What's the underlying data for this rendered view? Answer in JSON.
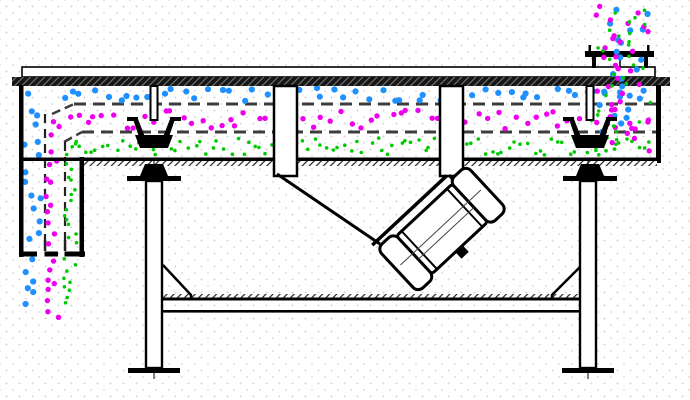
{
  "diagram": {
    "background": "#ffffff",
    "line_color": "#000000",
    "mesh_dash_color": "#3c3c3c"
  },
  "particle_colors": {
    "coarse": "#1E90FF",
    "medium": "#EE00EE",
    "fine": "#00CB00"
  },
  "particle_regions": [
    {
      "id": "coarse-top-deck-band",
      "layer": "mid",
      "color": "coarse",
      "r": 3.1,
      "axis": "x",
      "x": [
        55,
        650
      ],
      "y": [
        88,
        101
      ],
      "count": 52,
      "seed": 11
    },
    {
      "id": "medium-mid-deck-band",
      "layer": "mid",
      "color": "medium",
      "r": 2.7,
      "axis": "x",
      "x": [
        62,
        652
      ],
      "y": [
        110,
        129
      ],
      "count": 62,
      "seed": 22
    },
    {
      "id": "fine-bottom-pan-band",
      "layer": "mid",
      "color": "fine",
      "r": 1.8,
      "axis": "x",
      "x": [
        70,
        652
      ],
      "y": [
        138,
        155
      ],
      "count": 96,
      "seed": 33
    },
    {
      "id": "coarse-discharge-column",
      "layer": "mid",
      "color": "coarse",
      "r": 3.1,
      "axis": "y",
      "x": [
        24,
        42
      ],
      "y": [
        92,
        248
      ],
      "count": 15,
      "seed": 44
    },
    {
      "id": "medium-discharge-column",
      "layer": "mid",
      "color": "medium",
      "r": 2.7,
      "axis": "y",
      "x": [
        46,
        60
      ],
      "y": [
        114,
        248
      ],
      "count": 14,
      "seed": 55
    },
    {
      "id": "fine-discharge-column",
      "layer": "mid",
      "color": "fine",
      "r": 1.8,
      "axis": "y",
      "x": [
        64,
        78
      ],
      "y": [
        140,
        248
      ],
      "count": 17,
      "seed": 66
    },
    {
      "id": "coarse-falling-stream",
      "layer": "mid",
      "color": "coarse",
      "r": 3.1,
      "axis": "y",
      "x": [
        24,
        35
      ],
      "y": [
        258,
        308
      ],
      "count": 6,
      "seed": 77
    },
    {
      "id": "medium-falling-stream",
      "layer": "mid",
      "color": "medium",
      "r": 2.7,
      "axis": "y",
      "x": [
        45,
        60
      ],
      "y": [
        258,
        320
      ],
      "count": 8,
      "seed": 88
    },
    {
      "id": "fine-falling-stream",
      "layer": "mid",
      "color": "fine",
      "r": 1.8,
      "axis": "y",
      "x": [
        63,
        79
      ],
      "y": [
        258,
        306
      ],
      "count": 9,
      "seed": 99
    },
    {
      "id": "feed-spread-coarse",
      "layer": "mid",
      "color": "coarse",
      "r": 3.1,
      "axis": "y",
      "x": [
        596,
        650
      ],
      "y": [
        88,
        132
      ],
      "count": 9,
      "seed": 101
    },
    {
      "id": "feed-spread-medium",
      "layer": "mid",
      "color": "medium",
      "r": 2.7,
      "axis": "y",
      "x": [
        588,
        652
      ],
      "y": [
        88,
        152
      ],
      "count": 13,
      "seed": 102
    },
    {
      "id": "feed-spread-fine",
      "layer": "mid",
      "color": "fine",
      "r": 1.8,
      "axis": "y",
      "x": [
        586,
        652
      ],
      "y": [
        90,
        156
      ],
      "count": 15,
      "seed": 103
    },
    {
      "id": "feed-cloud-coarse",
      "layer": "top",
      "color": "coarse",
      "r": 3.1,
      "axis": "y",
      "x": [
        600,
        648
      ],
      "y": [
        8,
        58
      ],
      "count": 9,
      "seed": 104
    },
    {
      "id": "feed-cloud-medium",
      "layer": "top",
      "color": "medium",
      "r": 2.7,
      "axis": "y",
      "x": [
        595,
        652
      ],
      "y": [
        5,
        58
      ],
      "count": 13,
      "seed": 105
    },
    {
      "id": "feed-cloud-fine",
      "layer": "top",
      "color": "fine",
      "r": 1.8,
      "axis": "y",
      "x": [
        597,
        650
      ],
      "y": [
        8,
        58
      ],
      "count": 13,
      "seed": 106
    },
    {
      "id": "feed-stream-coarse",
      "layer": "top",
      "color": "coarse",
      "r": 3.1,
      "axis": "y",
      "x": [
        606,
        642
      ],
      "y": [
        58,
        90
      ],
      "count": 5,
      "seed": 107
    },
    {
      "id": "feed-stream-medium",
      "layer": "top",
      "color": "medium",
      "r": 2.7,
      "axis": "y",
      "x": [
        603,
        645
      ],
      "y": [
        56,
        90
      ],
      "count": 7,
      "seed": 108
    },
    {
      "id": "feed-stream-fine",
      "layer": "top",
      "color": "fine",
      "r": 1.8,
      "axis": "y",
      "x": [
        604,
        644
      ],
      "y": [
        58,
        90
      ],
      "count": 7,
      "seed": 109
    }
  ]
}
